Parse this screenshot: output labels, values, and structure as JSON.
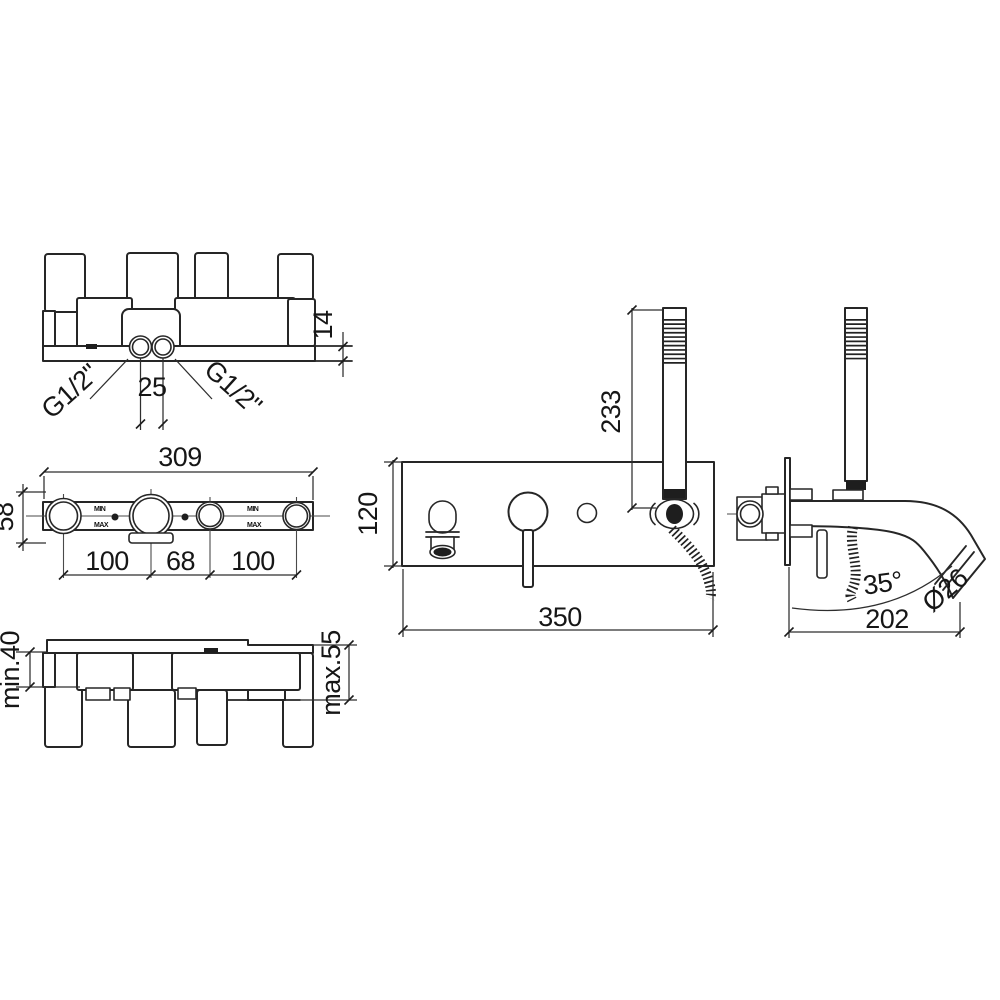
{
  "background": "#ffffff",
  "line_color": "#262626",
  "views": {
    "body_front": {
      "labels": {
        "thread_left": "G1/2\"",
        "thread_right": "G1/2\"",
        "spacing": "25",
        "rail_thickness": "14"
      }
    },
    "body_face": {
      "labels": {
        "width": "309",
        "height": "58",
        "left_span": "100",
        "center_span": "68",
        "right_span": "100",
        "min_mark": "MIN",
        "max_mark": "MAX"
      }
    },
    "body_depth": {
      "labels": {
        "min_depth": "min.40",
        "max_depth": "max.55"
      }
    },
    "trim_front": {
      "labels": {
        "handshower_height": "233",
        "plate_height": "120",
        "plate_width": "350"
      }
    },
    "trim_side": {
      "labels": {
        "spout_angle": "35°",
        "spout_diameter": "Ø26",
        "spout_reach": "202"
      }
    }
  }
}
